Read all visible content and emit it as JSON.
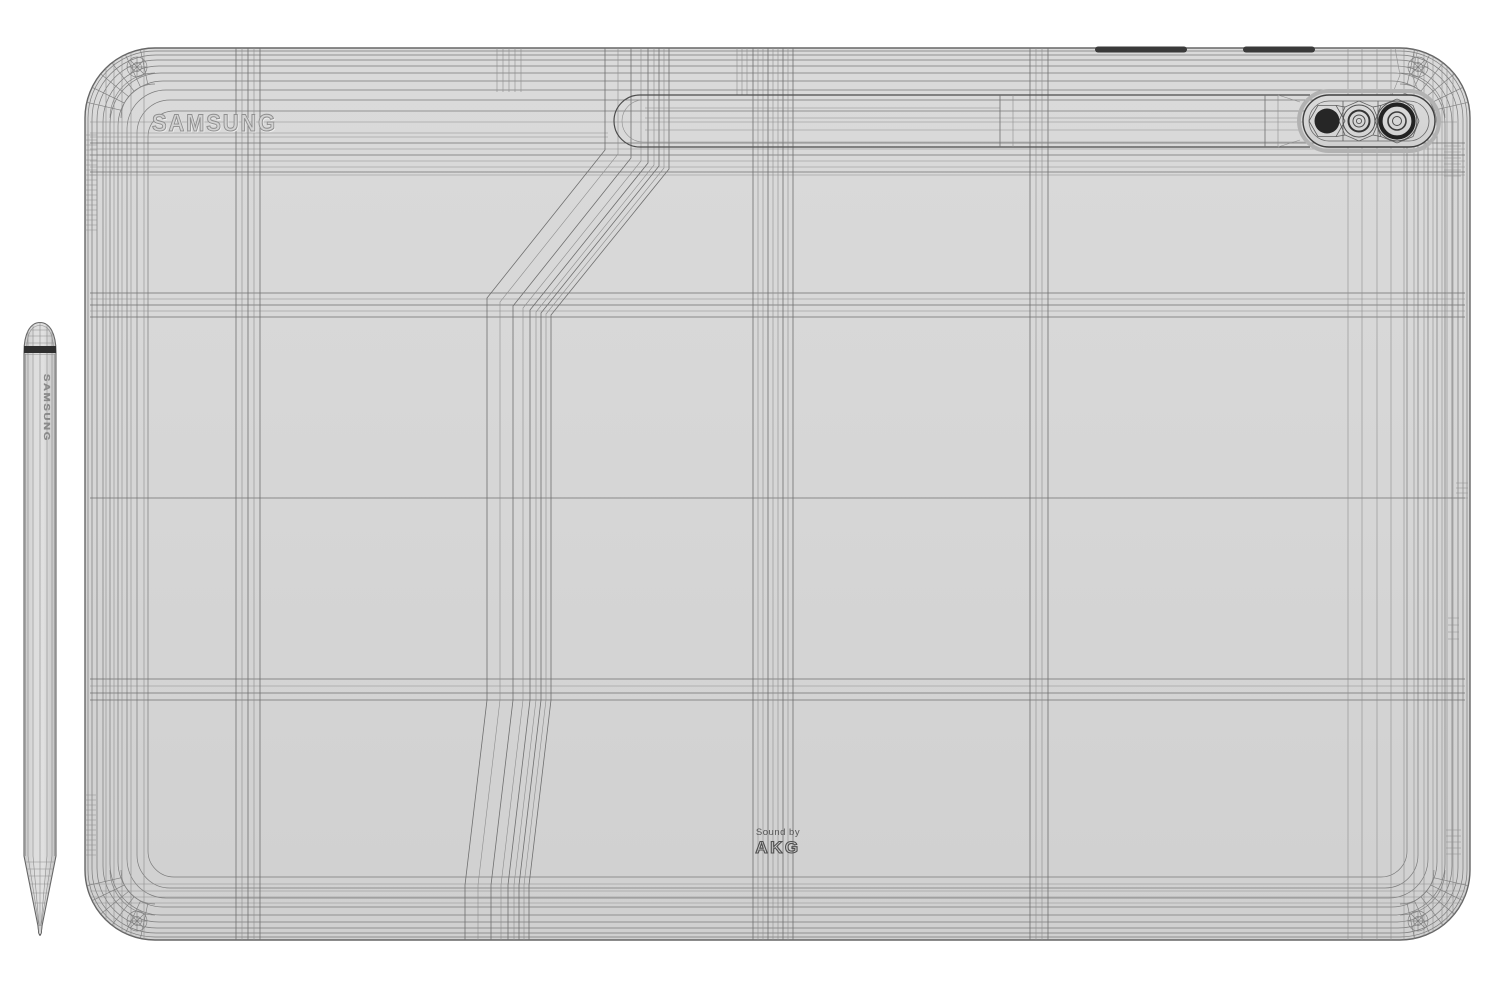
{
  "scene": {
    "description": "Wireframe 3D render of a Samsung tablet rear panel with S Pen stylus",
    "colors": {
      "background": "#ffffff",
      "body": "#d6d6d6",
      "wireframe_line": "#6f6f6f",
      "camera_dark": "#262626",
      "button_dark": "#3a3a3a",
      "pen_band_dark": "#2f2f2f"
    }
  },
  "tablet": {
    "brand_logo": "SAMSUNG",
    "audio_branding": {
      "line1": "Sound by",
      "line2": "AKG"
    }
  },
  "stylus": {
    "brand_text": "SAMSUNG"
  }
}
